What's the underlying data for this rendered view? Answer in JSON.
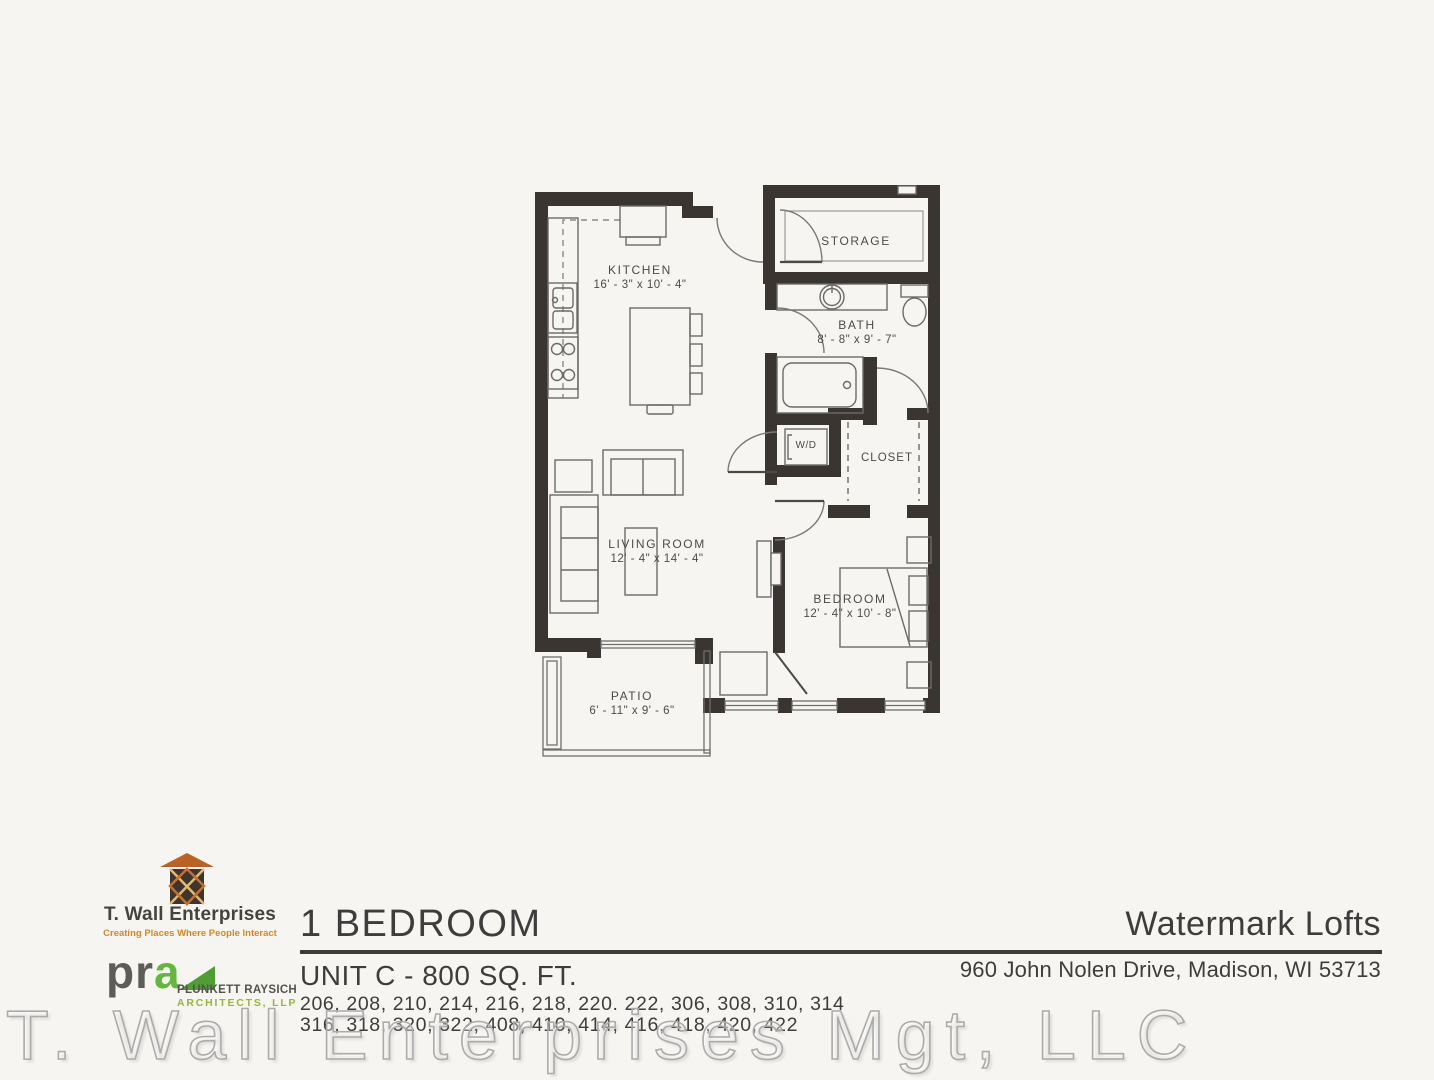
{
  "floor_plan": {
    "rooms": {
      "kitchen": {
        "name": "KITCHEN",
        "dims": "16' - 3\" x 10' - 4\""
      },
      "storage": {
        "name": "STORAGE"
      },
      "bath": {
        "name": "BATH",
        "dims": "8' - 8\" x 9' - 7\""
      },
      "wd": {
        "name": "W/D"
      },
      "closet": {
        "name": "CLOSET"
      },
      "living_room": {
        "name": "LIVING ROOM",
        "dims": "12' - 4\" x 14' - 4\""
      },
      "bedroom": {
        "name": "BEDROOM",
        "dims": "12' - 4\" x 10' - 8\""
      },
      "patio": {
        "name": "PATIO",
        "dims": "6' - 11\" x 9' - 6\""
      }
    }
  },
  "footer": {
    "twall_logo": {
      "name": "T. Wall Enterprises",
      "tagline": "Creating Places Where People Interact"
    },
    "pra_logo": {
      "abbr_pr": "pr",
      "abbr_a": "a",
      "line1": "PLUNKETT RAYSICH",
      "line2": "ARCHITECTS, LLP"
    },
    "unit": {
      "title": "1 BEDROOM",
      "subtitle": "UNIT C - 800 SQ. FT.",
      "units_line1": "206, 208, 210, 214, 216, 218, 220. 222, 306, 308, 310, 314",
      "units_line2": "316, 318, 320, 322, 408, 410, 414, 416, 418, 420, 422"
    },
    "property": {
      "name": "Watermark Lofts",
      "address": "960 John Nolen Drive, Madison, WI 53713"
    }
  },
  "watermark": "T. Wall Enterprises Mgt, LLC",
  "colors": {
    "wall": "#3a3531",
    "accent_orange": "#dd861f",
    "accent_green": "#64b73e",
    "text_dark": "#3d3d3d"
  }
}
